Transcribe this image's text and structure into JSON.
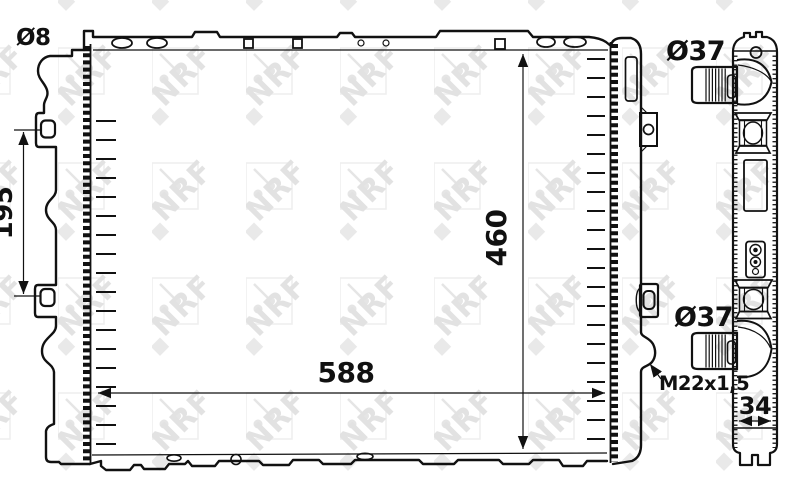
{
  "watermark": {
    "brand": "NRF"
  },
  "front_view": {
    "width_dim": "588",
    "height_dim": "460",
    "bracket_spacing_dim": "195",
    "bracket_hole_diameter": "Ø8",
    "drain_plug_thread": "M22x1,5"
  },
  "side_view": {
    "top_pipe_diameter": "Ø37",
    "bottom_pipe_diameter": "Ø37",
    "depth_dim": "34"
  }
}
